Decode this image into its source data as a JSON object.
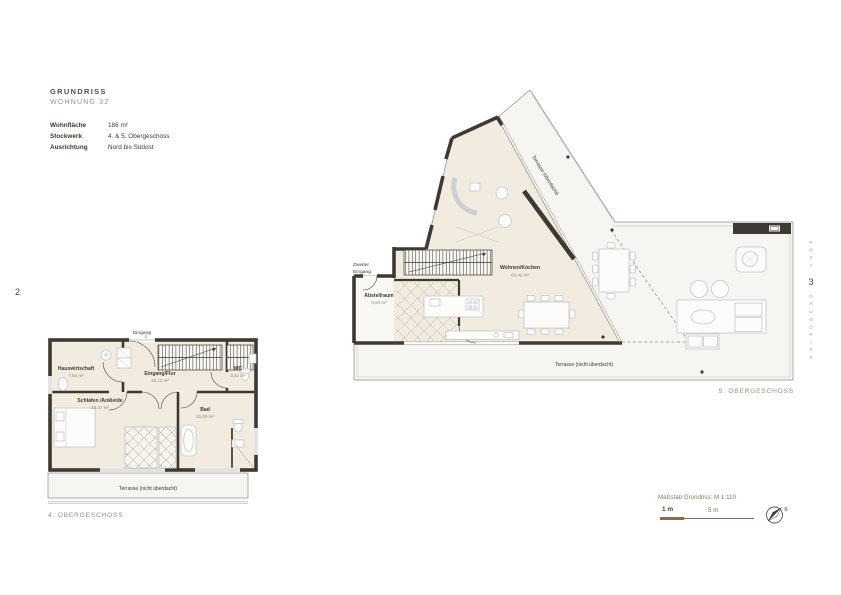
{
  "page": {
    "left_page_number": "2",
    "right_page_number": "3",
    "spine_top": "ROXY",
    "spine_bottom": "GRUNDRISS"
  },
  "header": {
    "title": "GRUNDRISS",
    "subtitle": "WOHNUNG 32",
    "specs": [
      {
        "label": "Wohnfläche",
        "value": "186 m²"
      },
      {
        "label": "Stockwerk",
        "value": "4. & 5. Obergeschoss"
      },
      {
        "label": "Ausrichtung",
        "value": "Nord bis Südost"
      }
    ]
  },
  "plan4": {
    "caption": "4. OBERGESCHOSS",
    "entrance_label": "Eingang",
    "rooms": [
      {
        "name": "Hauswirtschaft",
        "area": "7,54 m²"
      },
      {
        "name": "Eingang/Flur",
        "area": "15,13 m²"
      },
      {
        "name": "WC",
        "area": "3,51 m²"
      },
      {
        "name": "Schlafen /Ankleide",
        "area": "23,47 m²"
      },
      {
        "name": "Bad",
        "area": "10,09 m²"
      }
    ],
    "terrace_label": "Terrasse (nicht überdacht)"
  },
  "plan5": {
    "caption": "5. OBERGESCHOSS",
    "second_entrance_line1": "Zweiter",
    "second_entrance_line2": "Eingang",
    "rooms": [
      {
        "name": "Abstellraum",
        "area": "6,94 m²"
      },
      {
        "name": "Wohnen/Kochen",
        "area": "64,42 m²"
      }
    ],
    "covered_terrace_label": "Terrasse (überdacht)",
    "terrace_label": "Terrasse (nicht überdacht)"
  },
  "scale": {
    "label": "Maßstab Grundriss: M 1:110",
    "tick_primary": "1 m",
    "tick_secondary": "5 m",
    "north": "N"
  },
  "colors": {
    "wall": "#3f3933",
    "interior": "#f1ebe0",
    "terrace": "#f6f5f2",
    "accent_brown": "#8b6b4e",
    "text_dark": "#3e3933",
    "text_muted": "#9a948a",
    "furniture": "#c3c7cb"
  }
}
